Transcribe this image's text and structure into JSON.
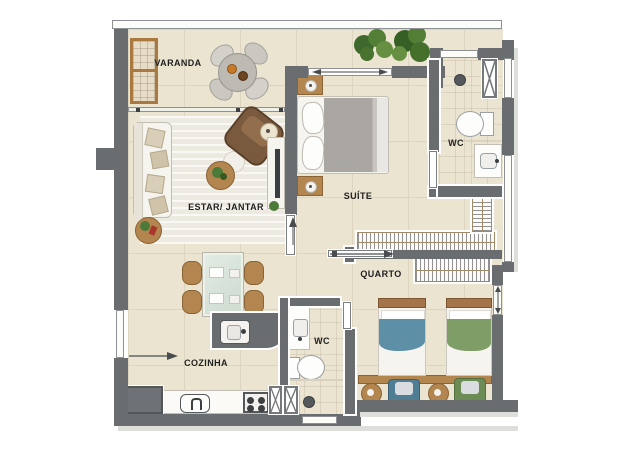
{
  "rooms": [
    {
      "id": "varanda",
      "label": "VARANDA"
    },
    {
      "id": "estar-jantar",
      "label": "ESTAR/ JANTAR"
    },
    {
      "id": "suite",
      "label": "SUÍTE"
    },
    {
      "id": "wc-suite",
      "label": "WC"
    },
    {
      "id": "quarto",
      "label": "QUARTO"
    },
    {
      "id": "cozinha",
      "label": "COZINHA"
    },
    {
      "id": "wc-social",
      "label": "WC"
    }
  ],
  "palette": {
    "wall": "#696d70",
    "floor": "#ebe4d1",
    "tile_line": "#ded5c0",
    "rug": "#f2efe6",
    "wood": "#b3854f",
    "wood_dark": "#8a6335",
    "bed_blue": "#5d8fa6",
    "bed_green": "#7f9d66",
    "blanket_gray": "#aaa7a2",
    "plant_green": "#4c7a38",
    "appliance_gray": "#6e7276"
  }
}
